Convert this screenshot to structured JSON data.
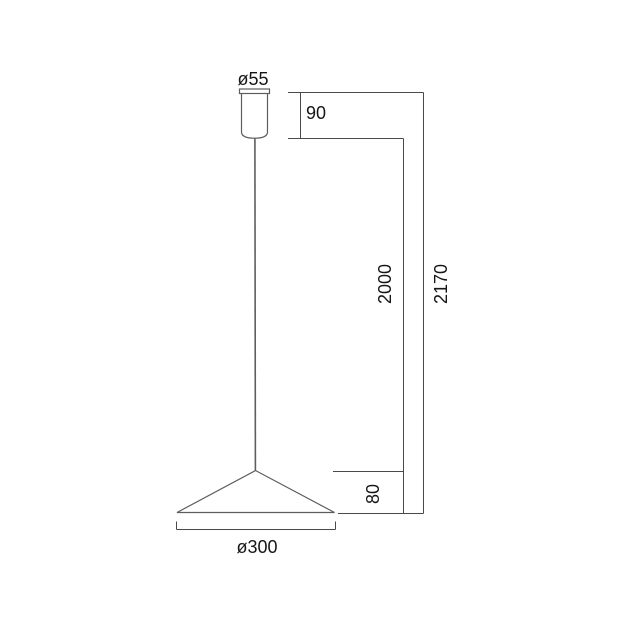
{
  "page": {
    "background": "#ffffff"
  },
  "drawing": {
    "kind": "technical-dimension-drawing",
    "subject": "pendant-lamp",
    "line_color": "#4a4a4a",
    "object_line_color": "#5e5e5e",
    "text_color": "#161616",
    "labels": {
      "canopy_diameter": "ø55",
      "canopy_height": "90",
      "suspension_length": "2000",
      "total_height": "2170",
      "shade_height": "80",
      "shade_diameter": "ø300"
    }
  }
}
